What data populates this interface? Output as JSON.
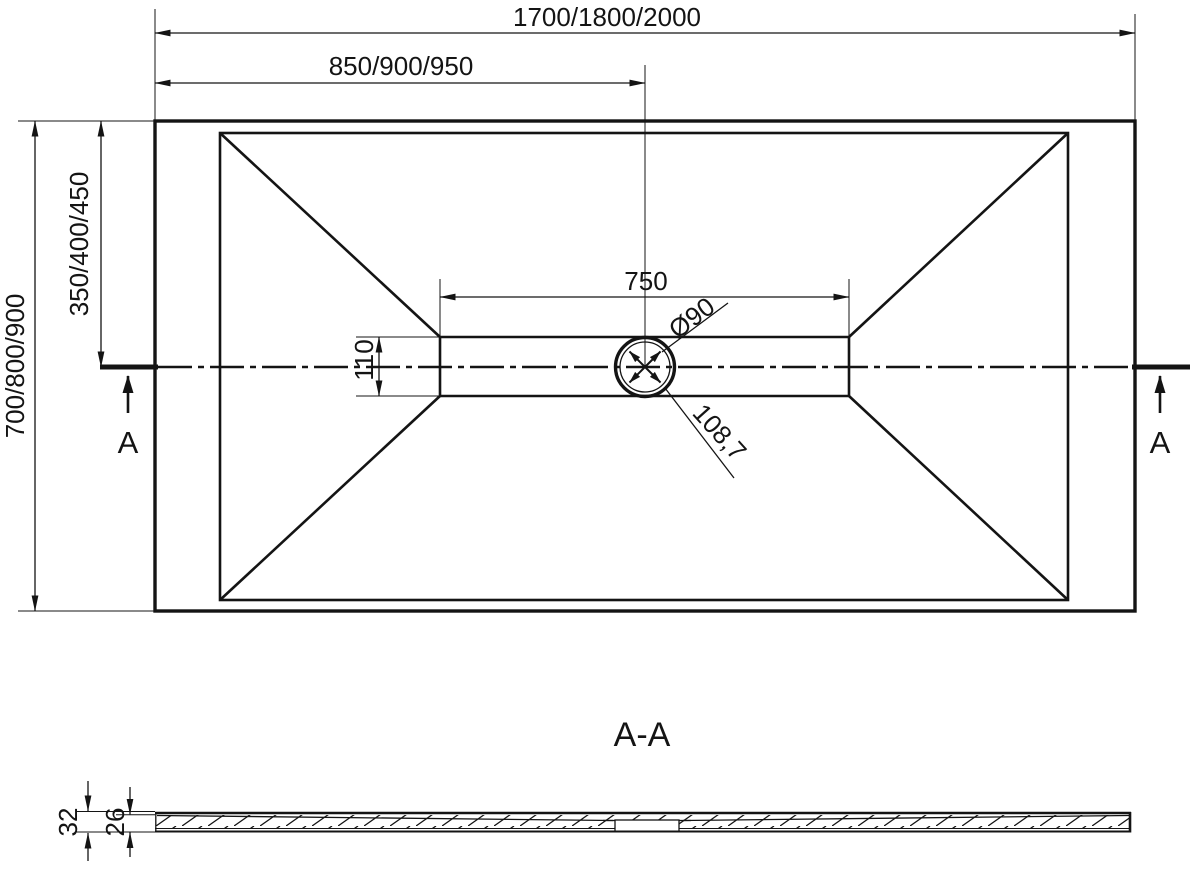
{
  "colors": {
    "line": "#141414",
    "background": "#ffffff"
  },
  "plan": {
    "dim_total_width": "1700/1800/2000",
    "dim_half_width": "850/900/950",
    "dim_total_height": "700/800/900",
    "dim_half_height": "350/400/450",
    "dim_channel_length": "750",
    "dim_channel_width": "110",
    "dim_drain_diameter": "Ø90",
    "dim_drain_diagonal": "108,7",
    "section_marker_left": "A",
    "section_marker_right": "A"
  },
  "section": {
    "title": "A-A",
    "dim_total_thickness": "32",
    "dim_base_thickness": "26"
  }
}
